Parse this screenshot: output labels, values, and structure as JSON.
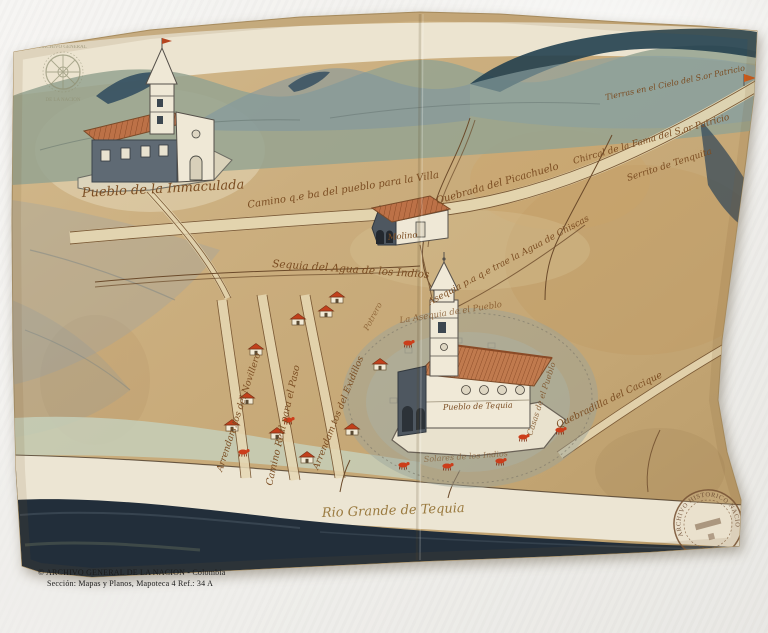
{
  "photo": {
    "background_color": "#f3f2ef",
    "caption": {
      "line1": "© ARCHIVO GENERAL DE LA NACION - Colombia",
      "line2": "Sección: Mapas y Planos, Mapoteca 4 Ref.: 34 A"
    }
  },
  "map": {
    "medium": "manuscript watercolor map",
    "ink_color": "#7b4d22",
    "colors": {
      "paper": "#c9ad80",
      "paper_light": "#ddc9a2",
      "paper_dark": "#b3925f",
      "mountain_sage": "#95a390",
      "mountain_blue": "#7e95a0",
      "mountain_dark": "#24404f",
      "river_cream": "#ece5d3",
      "bank_dark": "#222e3a",
      "roof_red": "#c2401c",
      "roof_tile": "#bc7147",
      "wash_green": "#c6d1bd",
      "village_wash": "#9aa49e"
    },
    "stamps": {
      "seal_top": "ARCHIVO GENERAL",
      "seal_bottom": "DE LA NACION",
      "round_stamp_text": "ARCHIVO HISTORICO NACIONAL"
    },
    "labels": [
      {
        "id": "pueblo-inmaculada",
        "text": "Pueblo de la Inmaculada",
        "x": 82,
        "y": 197,
        "rot": -3,
        "size": 13
      },
      {
        "id": "camino-villa",
        "text": "Camino q.e ba del pueblo para la Villa",
        "x": 248,
        "y": 208,
        "rot": -9,
        "size": 10
      },
      {
        "id": "tierras-patricio",
        "text": "Tierras en el Cielo del S.or Patricio",
        "x": 606,
        "y": 100,
        "rot": -12,
        "size": 8
      },
      {
        "id": "fama-patricio",
        "text": "Chircal de la Fama del S.or Patricio",
        "x": 574,
        "y": 164,
        "rot": -16,
        "size": 9
      },
      {
        "id": "serrito-tenquita",
        "text": "Serrito de Tenquita",
        "x": 628,
        "y": 181,
        "rot": -18,
        "size": 9
      },
      {
        "id": "quebrada-picachuelo",
        "text": "Quebrada del Picachuelo",
        "x": 437,
        "y": 204,
        "rot": -16,
        "size": 10
      },
      {
        "id": "molino",
        "text": "Molino",
        "x": 388,
        "y": 240,
        "rot": -5,
        "size": 8.5
      },
      {
        "id": "sequia-indios",
        "text": "Sequia del Agua de los Indios",
        "x": 272,
        "y": 267,
        "rot": 4,
        "size": 10.5
      },
      {
        "id": "asequia-chiscas",
        "text": "Asequia p.a q.e trae la Agua de Chiscas",
        "x": 430,
        "y": 305,
        "rot": -28,
        "size": 9
      },
      {
        "id": "asequia-pueblo",
        "text": "La Asequia de el Pueblo",
        "x": 400,
        "y": 323,
        "rot": -9,
        "size": 8.5,
        "opacity": 0.75
      },
      {
        "id": "potrero",
        "text": "Potrero",
        "x": 368,
        "y": 331,
        "rot": -62,
        "size": 8,
        "opacity": 0.7
      },
      {
        "id": "quebradilla-cacique",
        "text": "Quebradilla del Cacique",
        "x": 558,
        "y": 428,
        "rot": -26,
        "size": 9.5
      },
      {
        "id": "novillero",
        "text": "Arrendam.tos del Novillero",
        "x": 222,
        "y": 472,
        "rot": -72,
        "size": 9
      },
      {
        "id": "camino-real",
        "text": "Camino Real para el Paso",
        "x": 272,
        "y": 486,
        "rot": -77,
        "size": 9.5
      },
      {
        "id": "exidillos",
        "text": "Arrendam.tos del Exidillos",
        "x": 318,
        "y": 470,
        "rot": -68,
        "size": 9
      },
      {
        "id": "casas-pueblo",
        "text": "Casas de el Pueblo",
        "x": 532,
        "y": 436,
        "rot": -72,
        "size": 8,
        "opacity": 0.8
      },
      {
        "id": "solares-indios",
        "text": "Solares de los Indios",
        "x": 424,
        "y": 462,
        "rot": -4,
        "size": 8,
        "opacity": 0.6
      },
      {
        "id": "pueblo-central",
        "text": "Pueblo de Tequia",
        "x": 443,
        "y": 410,
        "rot": -2,
        "size": 8
      },
      {
        "id": "rio-grande",
        "text": "Rio Grande de Tequia",
        "x": 322,
        "y": 517,
        "rot": -2,
        "size": 13,
        "color": "#9a7a3f"
      }
    ]
  }
}
